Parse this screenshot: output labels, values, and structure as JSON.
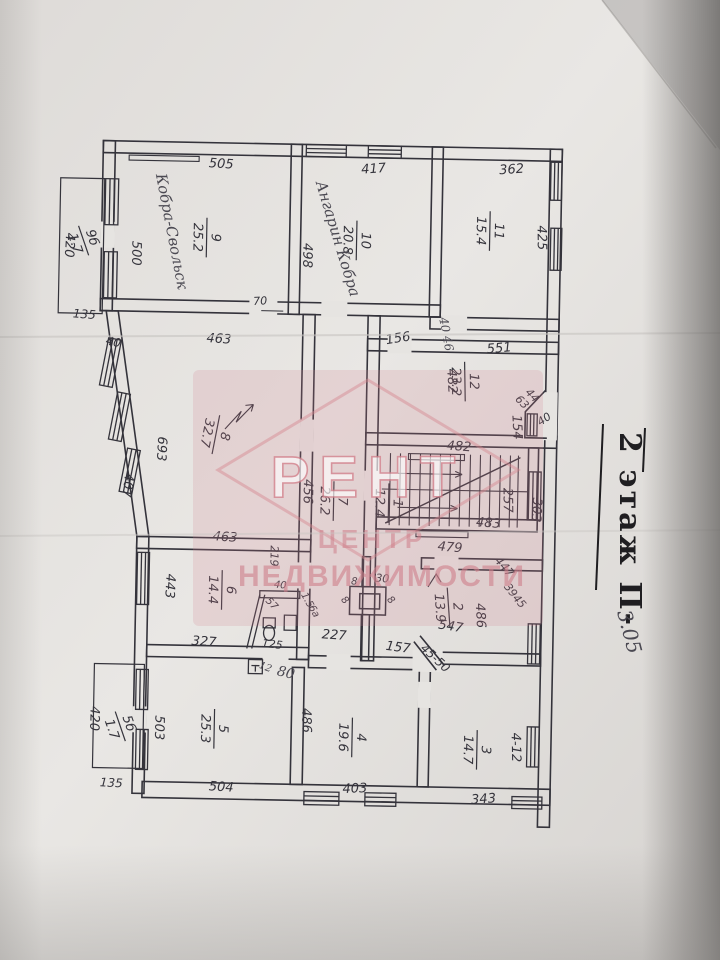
{
  "photo": {
    "paper": "#e6e4e1",
    "paper_dark": "#d2cfcc",
    "line": "#34333b",
    "pink": "#d4848f",
    "ink": "#1f1e21",
    "pencil": "#4b4952"
  },
  "stamp": {
    "line1": "2 этаж П-",
    "line2": "3.05"
  },
  "watermark": {
    "logo": "РЕНТ",
    "line1": "ЦЕНТР",
    "line2": "НЕДВИЖИМОСТИ"
  },
  "rooms": [
    {
      "id": "9",
      "area": "25.2",
      "x": 203,
      "y": 240,
      "r": 90
    },
    {
      "id": "10",
      "area": "20.8",
      "x": 353,
      "y": 240,
      "r": 90
    },
    {
      "id": "11",
      "area": "15.4",
      "x": 486,
      "y": 228,
      "r": 90
    },
    {
      "id": "12",
      "area": "23.2",
      "x": 464,
      "y": 379,
      "r": 88
    },
    {
      "id": "8",
      "area": "32.7",
      "x": 216,
      "y": 437,
      "r": 100
    },
    {
      "id": "7",
      "area": "26.2",
      "x": 335,
      "y": 501,
      "r": 90
    },
    {
      "id": "1",
      "area": "12.4",
      "x": 390,
      "y": 502,
      "r": 90
    },
    {
      "id": "6",
      "area": "14.4",
      "x": 225,
      "y": 592,
      "r": 90
    },
    {
      "id": "5",
      "area": "25.3",
      "x": 220,
      "y": 731,
      "r": 90
    },
    {
      "id": "4",
      "area": "19.6",
      "x": 358,
      "y": 737,
      "r": 90
    },
    {
      "id": "3",
      "area": "14.7",
      "x": 483,
      "y": 747,
      "r": 90
    },
    {
      "id": "2",
      "area": "13.9",
      "x": 452,
      "y": 605,
      "r": 85
    },
    {
      "id": "9б",
      "area": "1.7",
      "x": 80,
      "y": 245,
      "r": 70
    },
    {
      "id": "5б",
      "area": "1.7",
      "x": 126,
      "y": 730,
      "r": 70
    }
  ],
  "dims": [
    {
      "text": "505",
      "x": 215,
      "y": 170,
      "r": 2
    },
    {
      "text": "417",
      "x": 368,
      "y": 172,
      "r": -5
    },
    {
      "text": "362",
      "x": 506,
      "y": 170,
      "r": -5
    },
    {
      "text": "500",
      "x": 128,
      "y": 257,
      "r": 90
    },
    {
      "text": "498",
      "x": 299,
      "y": 256,
      "r": 90
    },
    {
      "text": "425",
      "x": 533,
      "y": 234,
      "r": 88
    },
    {
      "text": "420",
      "x": 61,
      "y": 250,
      "r": 92
    },
    {
      "text": "135",
      "x": 81,
      "y": 323,
      "r": 3,
      "s": 12
    },
    {
      "text": "40",
      "x": 110,
      "y": 350,
      "r": 12,
      "s": 12
    },
    {
      "text": "70",
      "x": 257,
      "y": 306,
      "r": -4,
      "s": 11
    },
    {
      "text": "463",
      "x": 216,
      "y": 345,
      "r": 3
    },
    {
      "text": "156",
      "x": 396,
      "y": 341,
      "r": -10
    },
    {
      "text": "551",
      "x": 497,
      "y": 349,
      "r": -6
    },
    {
      "text": "482",
      "x": 446,
      "y": 379,
      "r": 86
    },
    {
      "text": "44",
      "x": 528,
      "y": 394,
      "r": 45,
      "s": 11
    },
    {
      "text": "63",
      "x": 518,
      "y": 401,
      "r": 45,
      "s": 11
    },
    {
      "text": "40",
      "x": 545,
      "y": 418,
      "r": -35,
      "s": 11
    },
    {
      "text": "154",
      "x": 512,
      "y": 424,
      "r": 86
    },
    {
      "text": "693",
      "x": 157,
      "y": 452,
      "r": 92
    },
    {
      "text": "407",
      "x": 124,
      "y": 489,
      "r": 95
    },
    {
      "text": "456",
      "x": 304,
      "y": 492,
      "r": 90
    },
    {
      "text": "219",
      "x": 272,
      "y": 557,
      "r": 90,
      "s": 11
    },
    {
      "text": "482",
      "x": 458,
      "y": 448,
      "r": 3
    },
    {
      "text": "483",
      "x": 489,
      "y": 524,
      "r": 3
    },
    {
      "text": "479",
      "x": 451,
      "y": 549,
      "r": 4
    },
    {
      "text": "257",
      "x": 504,
      "y": 497,
      "r": 88
    },
    {
      "text": "303",
      "x": 533,
      "y": 506,
      "r": 92
    },
    {
      "text": "463",
      "x": 226,
      "y": 543,
      "r": 3
    },
    {
      "text": "447",
      "x": 503,
      "y": 566,
      "r": 48,
      "s": 12
    },
    {
      "text": "39",
      "x": 510,
      "y": 589,
      "r": 52,
      "s": 11
    },
    {
      "text": "45",
      "x": 519,
      "y": 600,
      "r": 48,
      "s": 11
    },
    {
      "text": "30",
      "x": 384,
      "y": 581,
      "r": 3,
      "s": 11
    },
    {
      "text": "8",
      "x": 356,
      "y": 584,
      "r": 3,
      "s": 10
    },
    {
      "text": "8",
      "x": 345,
      "y": 602,
      "r": 45,
      "s": 10
    },
    {
      "text": "8",
      "x": 391,
      "y": 601,
      "r": 45,
      "s": 10
    },
    {
      "text": "227",
      "x": 337,
      "y": 639,
      "r": 3
    },
    {
      "text": "157",
      "x": 401,
      "y": 650,
      "r": 6
    },
    {
      "text": "45-50",
      "x": 436,
      "y": 659,
      "r": 42,
      "s": 12
    },
    {
      "text": "547",
      "x": 453,
      "y": 628,
      "r": 8
    },
    {
      "text": "486",
      "x": 479,
      "y": 613,
      "r": 86
    },
    {
      "text": "486",
      "x": 307,
      "y": 721,
      "r": 88
    },
    {
      "text": "443",
      "x": 168,
      "y": 589,
      "r": 92
    },
    {
      "text": "327",
      "x": 207,
      "y": 648,
      "r": 3
    },
    {
      "text": "40",
      "x": 282,
      "y": 589,
      "r": 5,
      "s": 10
    },
    {
      "text": "57",
      "x": 272,
      "y": 607,
      "r": 45,
      "s": 10
    },
    {
      "text": "1.5",
      "x": 307,
      "y": 602,
      "r": 60,
      "s": 10
    },
    {
      "text": "6а",
      "x": 314,
      "y": 613,
      "r": 60,
      "s": 10
    },
    {
      "text": "125",
      "x": 275,
      "y": 649,
      "r": 5,
      "s": 11
    },
    {
      "text": "503",
      "x": 160,
      "y": 731,
      "r": 90
    },
    {
      "text": "504",
      "x": 227,
      "y": 793,
      "r": 2
    },
    {
      "text": "420",
      "x": 95,
      "y": 723,
      "r": 90
    },
    {
      "text": "135",
      "x": 117,
      "y": 791,
      "r": 2,
      "s": 12
    },
    {
      "text": "403",
      "x": 361,
      "y": 792,
      "r": -3
    },
    {
      "text": "343",
      "x": 490,
      "y": 800,
      "r": -5
    },
    {
      "text": "4-12",
      "x": 517,
      "y": 744,
      "r": 88
    }
  ],
  "annotations": [
    {
      "text": "Кобра-Свольск",
      "x": 150,
      "y": 178,
      "r": 78,
      "s": 15
    },
    {
      "text": "Ангарин Кобра",
      "x": 310,
      "y": 183,
      "r": 72,
      "s": 15
    },
    {
      "text": "40 46",
      "x": 436,
      "y": 316,
      "r": 78,
      "s": 12
    },
    {
      "text": "12",
      "x": 262,
      "y": 669,
      "r": 20,
      "s": 10
    },
    {
      "text": "80",
      "x": 280,
      "y": 676,
      "r": 12,
      "s": 14
    }
  ]
}
